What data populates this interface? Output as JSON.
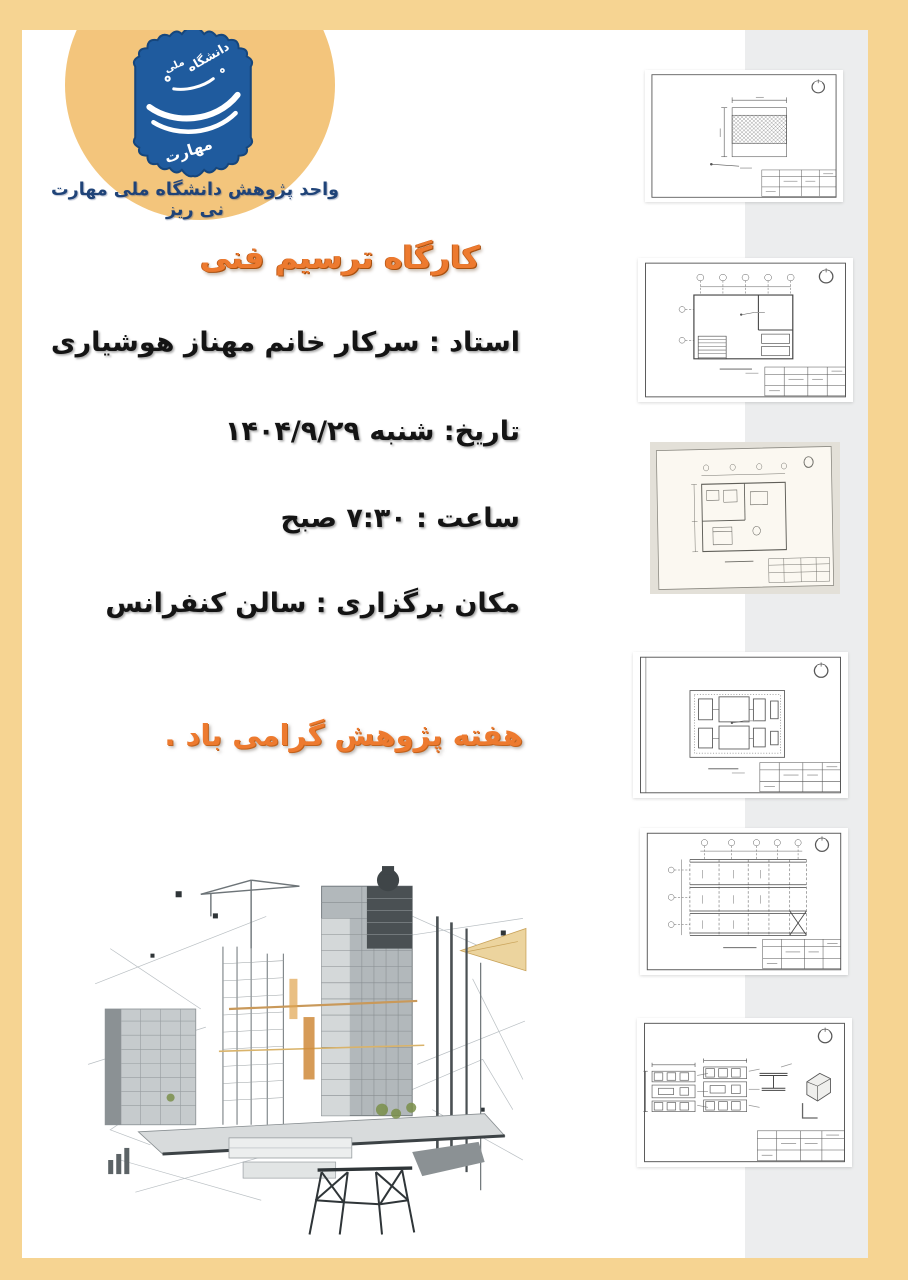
{
  "poster": {
    "border_color": "#f6d492",
    "paper_color": "#ffffff",
    "sidebar_color": "#ecedee"
  },
  "header": {
    "logo": {
      "emblem_color": "#1f5b9e",
      "halo_color": "#f3c57c",
      "calligraphy_top": "دانشگاه",
      "calligraphy_mid": "ملی",
      "calligraphy_main": "مهارت"
    },
    "org_line": "واحد پژوهش دانشگاه ملی مهارت نی ریز",
    "org_color": "#1f4378"
  },
  "announcement": {
    "title": "کارگاه ترسیم فنی",
    "title_color": "#ed7a2f",
    "instructor": "استاد : سرکار خانم مهناز هوشیاری",
    "date": "تاریخ: شنبه ۱۴۰۴/۹/۲۹",
    "time": "ساعت : ۷:۳۰ صبح",
    "venue": "مکان برگزاری : سالن کنفرانس",
    "note": "هفته پژوهش گرامی باد ."
  },
  "gallery": {
    "items": [
      {
        "name": "hatched-section-detail-sheet"
      },
      {
        "name": "floor-plan-sheet"
      },
      {
        "name": "furnished-floor-plan-photo"
      },
      {
        "name": "foundation-plan-sheet"
      },
      {
        "name": "beam-framing-plan-sheet"
      },
      {
        "name": "steel-details-sheet"
      }
    ]
  },
  "footer_art": {
    "name": "construction-collage"
  }
}
